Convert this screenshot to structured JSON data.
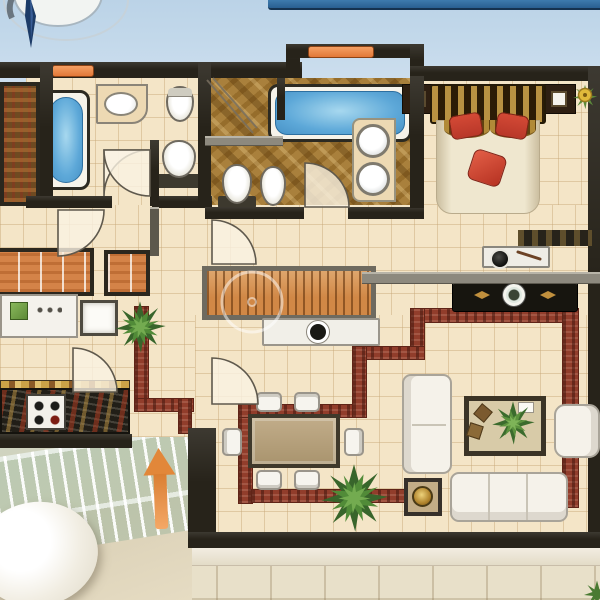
{
  "scene": {
    "kind": "residential-apartment-floor-plan-top-view",
    "areas": [
      "bathroom",
      "master-bathroom",
      "master-bedroom",
      "bedroom",
      "corridor",
      "kitchen",
      "dining-area",
      "living-room",
      "balcony",
      "terrace"
    ],
    "compass_present": true
  },
  "palette": {
    "sky": "#cfe0ee",
    "sky_bar": "#2a5f8e",
    "wall": "#27231a",
    "wall_gray": "#8d897e",
    "floor": "#f4e5c8",
    "tile_line": "rgba(196,166,118,0.45)",
    "bath_marble": "#a8803e",
    "partition_red": "#8f3d2c",
    "window_orange": "#e0793a",
    "water_blue": "#5fa8d6",
    "furniture_white": "#f5f2ea",
    "furniture_line": "#a9a499",
    "wardrobe_orange": "#d2834a",
    "headboard_gold": "#7a5a22",
    "pillow_red": "#b5382a",
    "accent_gold": "#c09040",
    "plant_green": "#4c7c36",
    "terrace": "#e8e0ca",
    "terrace_shade": "#d9cfb6",
    "railing_green": "#b9cdb6",
    "arrow_orange": "#e0873c",
    "console_black": "#17150f",
    "table_wood": "#b7a383",
    "counter_dark": "#211e17",
    "counter_tan": "#ecd9b4",
    "bed_cream": "#efe7d0",
    "compass_needle": "#1d3b66"
  },
  "symbols": [
    "compass-rose",
    "bathtub",
    "washbasin",
    "round-basin",
    "toilet",
    "bidet",
    "shower",
    "double-bed",
    "nightstand",
    "flower-vase",
    "wardrobe",
    "single-bed",
    "kitchen-counter",
    "stove",
    "dining-table",
    "dining-chair",
    "sofa",
    "loveseat",
    "armchair",
    "coffee-table-rug",
    "side-table",
    "tv-console",
    "dressing-desk",
    "potted-plant",
    "palm-plant",
    "entrance-arrow",
    "balcony-railing",
    "outdoor-chair",
    "window-marker",
    "door-swing",
    "watermark-ring"
  ]
}
